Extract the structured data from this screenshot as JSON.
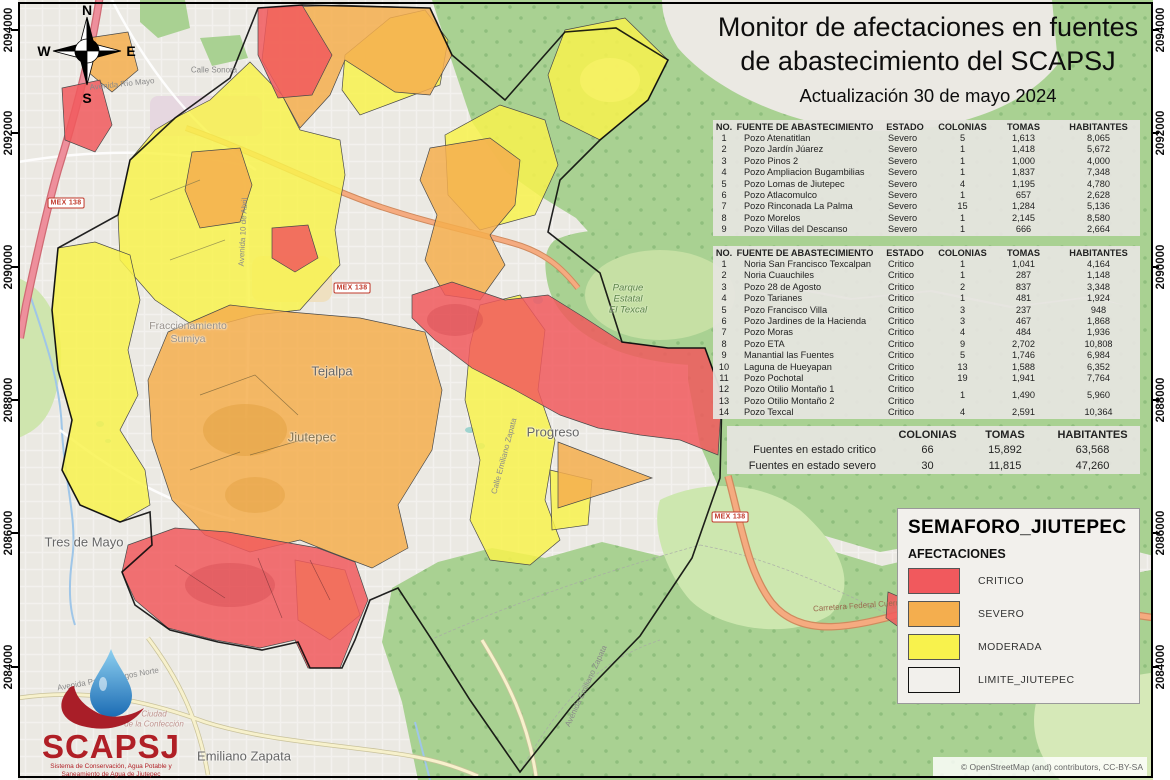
{
  "title": {
    "line1": "Monitor de afectaciones en fuentes",
    "line2": "de abastecimiento del SCAPSJ",
    "subtitle": "Actualización 30 de mayo 2024"
  },
  "tables": {
    "headers": [
      "NO.",
      "FUENTE DE ABASTECIMIENTO",
      "ESTADO",
      "COLONIAS",
      "TOMAS",
      "HABITANTES"
    ],
    "severo": {
      "rows": [
        [
          "1",
          "Pozo Atenatitlan",
          "Severo",
          "5",
          "1,613",
          "8,065"
        ],
        [
          "2",
          "Pozo Jardín Júarez",
          "Severo",
          "1",
          "1,418",
          "5,672"
        ],
        [
          "3",
          "Pozo Pinos 2",
          "Severo",
          "1",
          "1,000",
          "4,000"
        ],
        [
          "4",
          "Pozo Ampliacion Bugambilias",
          "Severo",
          "1",
          "1,837",
          "7,348"
        ],
        [
          "5",
          "Pozo Lomas de Jiutepec",
          "Severo",
          "4",
          "1,195",
          "4,780"
        ],
        [
          "6",
          "Pozo Atlacomulco",
          "Severo",
          "1",
          "657",
          "2,628"
        ],
        [
          "7",
          "Pozo Rinconada La Palma",
          "Severo",
          "15",
          "1,284",
          "5,136"
        ],
        [
          "8",
          "Pozo Morelos",
          "Severo",
          "1",
          "2,145",
          "8,580"
        ],
        [
          "9",
          "Pozo Villas del Descanso",
          "Severo",
          "1",
          "666",
          "2,664"
        ]
      ]
    },
    "critico": {
      "rows": [
        [
          "1",
          "Noria San Francisco Texcalpan",
          "Critico",
          "1",
          "1,041",
          "4,164"
        ],
        [
          "2",
          "Noria Cuauchiles",
          "Critico",
          "1",
          "287",
          "1,148"
        ],
        [
          "3",
          "Pozo 28 de Agosto",
          "Critico",
          "2",
          "837",
          "3,348"
        ],
        [
          "4",
          "Pozo Tarianes",
          "Critico",
          "1",
          "481",
          "1,924"
        ],
        [
          "5",
          "Pozo Francisco Villa",
          "Critico",
          "3",
          "237",
          "948"
        ],
        [
          "6",
          "Pozo Jardines de la Hacienda",
          "Critico",
          "3",
          "467",
          "1,868"
        ],
        [
          "7",
          "Pozo Moras",
          "Critico",
          "4",
          "484",
          "1,936"
        ],
        [
          "8",
          "Pozo ETA",
          "Critico",
          "9",
          "2,702",
          "10,808"
        ],
        [
          "9",
          "Manantial las Fuentes",
          "Critico",
          "5",
          "1,746",
          "6,984"
        ],
        [
          "10",
          "Laguna de Hueyapan",
          "Critico",
          "13",
          "1,588",
          "6,352"
        ],
        [
          "11",
          "Pozo Pochotal",
          "Critico",
          "19",
          "1,941",
          "7,764"
        ],
        [
          "12",
          "Pozo Otilio Montaño 1",
          "Critico",
          {
            "v": "1",
            "rs": 2
          },
          {
            "v": "1,490",
            "rs": 2
          },
          {
            "v": "5,960",
            "rs": 2
          }
        ],
        [
          "13",
          "Pozo Otilio Montaño 2",
          "Critico"
        ],
        [
          "14",
          "Pozo Texcal",
          "Critico",
          "4",
          "2,591",
          "10,364"
        ]
      ]
    }
  },
  "summary": {
    "headers": [
      "",
      "COLONIAS",
      "TOMAS",
      "HABITANTES"
    ],
    "rows": [
      [
        "Fuentes en estado critico",
        "66",
        "15,892",
        "63,568"
      ],
      [
        "Fuentes en estado severo",
        "30",
        "11,815",
        "47,260"
      ]
    ]
  },
  "legend": {
    "title": "SEMAFORO_JIUTEPEC",
    "subtitle": "AFECTACIONES",
    "items": [
      {
        "label": "CRITICO",
        "color": "#f1595d"
      },
      {
        "label": "SEVERO",
        "color": "#f4ae4e"
      },
      {
        "label": "MODERADA",
        "color": "#f8f24d"
      },
      {
        "label": "LIMITE_JIUTEPEC",
        "color": "#f2f0ec"
      }
    ]
  },
  "compass": {
    "north": "N",
    "south": "S",
    "east": "E",
    "west": "W"
  },
  "coordinates": {
    "values": [
      "2094000",
      "2092000",
      "2090000",
      "2088000",
      "2086000",
      "2084000"
    ],
    "ys": [
      30,
      133,
      267,
      400,
      533,
      667
    ]
  },
  "map_labels": [
    {
      "text": "Tejalpa",
      "x": 332,
      "y": 371,
      "cls": "town"
    },
    {
      "text": "Jiutepec",
      "x": 312,
      "y": 437,
      "cls": "town town-or"
    },
    {
      "text": "Progreso",
      "x": 553,
      "y": 432,
      "cls": "town"
    },
    {
      "text": "Tres de Mayo",
      "x": 84,
      "y": 542,
      "cls": "town"
    },
    {
      "text": "Emiliano Zapata",
      "x": 244,
      "y": 756,
      "cls": "town"
    },
    {
      "text": "Fraccionamiento",
      "x": 188,
      "y": 326,
      "cls": "small"
    },
    {
      "text": "Sumiya",
      "x": 188,
      "y": 339,
      "cls": "small"
    },
    {
      "text": "Parque",
      "x": 628,
      "y": 288,
      "cls": "park"
    },
    {
      "text": "Estatal",
      "x": 628,
      "y": 299,
      "cls": "park"
    },
    {
      "text": "El Texcal",
      "x": 628,
      "y": 310,
      "cls": "park"
    },
    {
      "text": "Ciudad",
      "x": 154,
      "y": 714,
      "cls": "pink"
    },
    {
      "text": "de la Confección",
      "x": 154,
      "y": 724,
      "cls": "pink"
    },
    {
      "text": "Avenida Río Mayo",
      "x": 122,
      "y": 84,
      "cls": "street",
      "rot": -6
    },
    {
      "text": "Calle Sonora",
      "x": 214,
      "y": 70,
      "cls": "street",
      "rot": 0
    },
    {
      "text": "Avenida 10 de Abril",
      "x": 243,
      "y": 232,
      "cls": "street",
      "rot": -87
    },
    {
      "text": "Avenida Paseo Burgos Norte",
      "x": 108,
      "y": 679,
      "cls": "street",
      "rot": -10
    },
    {
      "text": "Avenida Emiliano Zapata",
      "x": 586,
      "y": 686,
      "cls": "street",
      "rot": -65
    },
    {
      "text": "Calle Emiliano Zapata",
      "x": 504,
      "y": 456,
      "cls": "street",
      "rot": -75
    },
    {
      "text": "Carretera Federal Cuernavaca Cuautla",
      "x": 882,
      "y": 604,
      "cls": "street-r",
      "rot": -4
    }
  ],
  "road_shields": [
    {
      "text": "MEX 138",
      "x": 66,
      "y": 203
    },
    {
      "text": "MEX 138",
      "x": 352,
      "y": 288
    },
    {
      "text": "MEX 138",
      "x": 730,
      "y": 517
    }
  ],
  "logo": {
    "name": "SCAPSJ",
    "tagline1": "Sistema de Conservación, Agua Potable y",
    "tagline2": "Saneamiento de Agua de Jiutepec"
  },
  "attribution": "© OpenStreetMap (and) contributors, CC-BY-SA",
  "colors": {
    "critico": "#f1595d",
    "severo": "#f4ae4e",
    "moderada": "#f8f24d",
    "forest": "#a9d192",
    "urban": "#ebe9e3"
  }
}
